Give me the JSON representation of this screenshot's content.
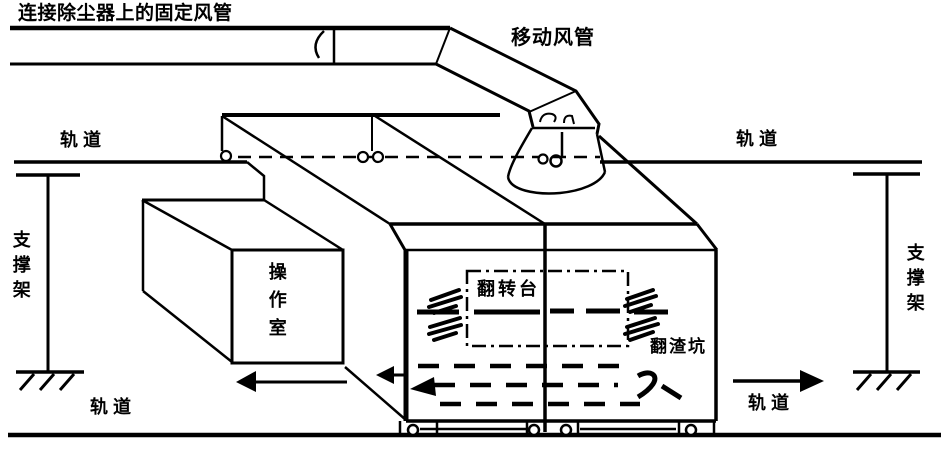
{
  "colors": {
    "ink": "#000000",
    "background": "#ffffff"
  },
  "labels": {
    "fixed_duct": "连接除尘器上的固定风管",
    "mobile_duct": "移动风管",
    "rail_top_left": "轨道",
    "rail_top_right": "轨道",
    "rail_bottom_left": "轨道",
    "rail_bottom_right": "轨道",
    "support_left": "支撑架",
    "support_right": "支撑架",
    "operation_room": "操作室",
    "turning_platform": "翻转台",
    "slag_pit": "翻渣坑"
  }
}
